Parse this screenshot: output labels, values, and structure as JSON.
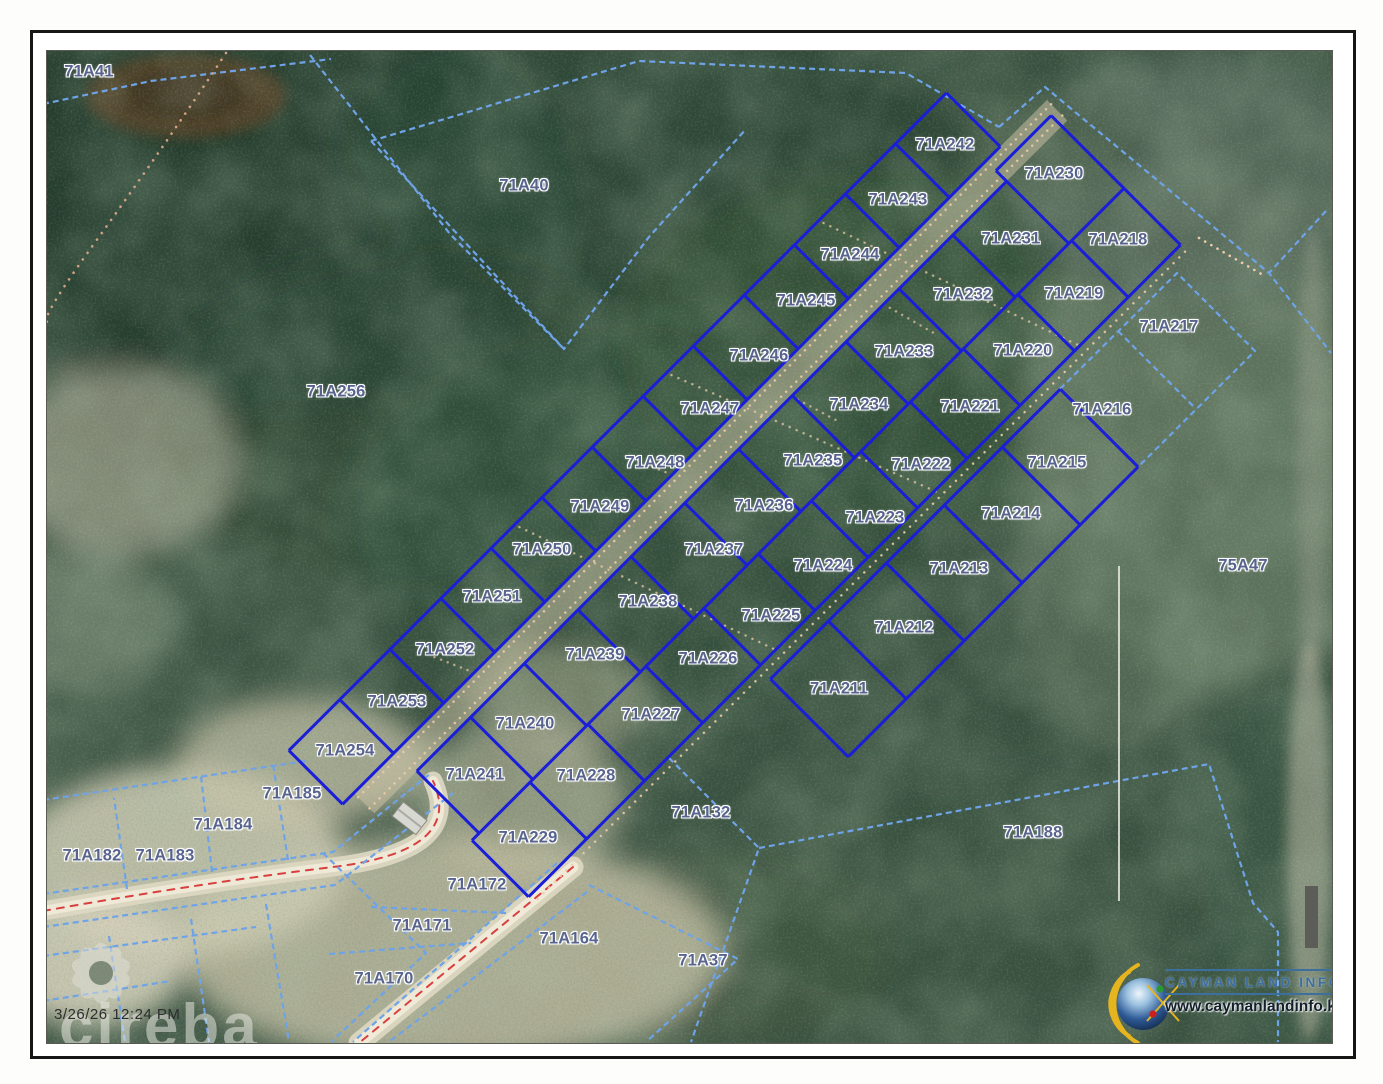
{
  "frame": {
    "border_color": "#161616"
  },
  "map": {
    "timestamp": "3/26/26 12:24 PM",
    "watermark_text": "cireba",
    "labels": [
      {
        "text": "71A41",
        "x": 88,
        "y": 71
      },
      {
        "text": "71A40",
        "x": 523,
        "y": 185
      },
      {
        "text": "71A256",
        "x": 335,
        "y": 391
      },
      {
        "text": "71A242",
        "x": 944,
        "y": 144
      },
      {
        "text": "71A243",
        "x": 897,
        "y": 199
      },
      {
        "text": "71A244",
        "x": 849,
        "y": 254
      },
      {
        "text": "71A245",
        "x": 805,
        "y": 300
      },
      {
        "text": "71A246",
        "x": 758,
        "y": 355
      },
      {
        "text": "71A247",
        "x": 709,
        "y": 408
      },
      {
        "text": "71A248",
        "x": 654,
        "y": 462
      },
      {
        "text": "71A249",
        "x": 599,
        "y": 506
      },
      {
        "text": "71A250",
        "x": 541,
        "y": 549
      },
      {
        "text": "71A251",
        "x": 491,
        "y": 596
      },
      {
        "text": "71A252",
        "x": 444,
        "y": 649
      },
      {
        "text": "71A253",
        "x": 396,
        "y": 701
      },
      {
        "text": "71A254",
        "x": 344,
        "y": 750
      },
      {
        "text": "71A230",
        "x": 1053,
        "y": 173
      },
      {
        "text": "71A231",
        "x": 1010,
        "y": 238
      },
      {
        "text": "71A218",
        "x": 1117,
        "y": 239
      },
      {
        "text": "71A232",
        "x": 962,
        "y": 294
      },
      {
        "text": "71A219",
        "x": 1073,
        "y": 293
      },
      {
        "text": "71A217",
        "x": 1168,
        "y": 326
      },
      {
        "text": "71A233",
        "x": 903,
        "y": 351
      },
      {
        "text": "71A220",
        "x": 1022,
        "y": 350
      },
      {
        "text": "71A234",
        "x": 858,
        "y": 404
      },
      {
        "text": "71A221",
        "x": 969,
        "y": 406
      },
      {
        "text": "71A216",
        "x": 1101,
        "y": 409
      },
      {
        "text": "71A235",
        "x": 812,
        "y": 460
      },
      {
        "text": "71A222",
        "x": 920,
        "y": 464
      },
      {
        "text": "71A215",
        "x": 1056,
        "y": 462
      },
      {
        "text": "71A236",
        "x": 763,
        "y": 505
      },
      {
        "text": "71A223",
        "x": 874,
        "y": 517
      },
      {
        "text": "71A214",
        "x": 1010,
        "y": 513
      },
      {
        "text": "71A237",
        "x": 713,
        "y": 549
      },
      {
        "text": "71A224",
        "x": 822,
        "y": 565
      },
      {
        "text": "71A213",
        "x": 958,
        "y": 568
      },
      {
        "text": "71A238",
        "x": 647,
        "y": 601
      },
      {
        "text": "71A225",
        "x": 770,
        "y": 615
      },
      {
        "text": "71A212",
        "x": 903,
        "y": 627
      },
      {
        "text": "71A239",
        "x": 594,
        "y": 654
      },
      {
        "text": "71A226",
        "x": 707,
        "y": 658
      },
      {
        "text": "71A211",
        "x": 838,
        "y": 688
      },
      {
        "text": "71A227",
        "x": 650,
        "y": 714
      },
      {
        "text": "71A240",
        "x": 524,
        "y": 723
      },
      {
        "text": "71A241",
        "x": 474,
        "y": 774
      },
      {
        "text": "71A228",
        "x": 585,
        "y": 775
      },
      {
        "text": "71A229",
        "x": 527,
        "y": 837
      },
      {
        "text": "71A185",
        "x": 291,
        "y": 793
      },
      {
        "text": "71A184",
        "x": 222,
        "y": 824
      },
      {
        "text": "71A182",
        "x": 91,
        "y": 855
      },
      {
        "text": "71A183",
        "x": 164,
        "y": 855
      },
      {
        "text": "71A132",
        "x": 700,
        "y": 812
      },
      {
        "text": "71A188",
        "x": 1032,
        "y": 832
      },
      {
        "text": "71A172",
        "x": 476,
        "y": 884
      },
      {
        "text": "71A171",
        "x": 421,
        "y": 925
      },
      {
        "text": "71A164",
        "x": 568,
        "y": 938
      },
      {
        "text": "71A170",
        "x": 383,
        "y": 978
      },
      {
        "text": "71A37",
        "x": 702,
        "y": 960
      },
      {
        "text": "75A47",
        "x": 1242,
        "y": 565
      }
    ]
  },
  "logo": {
    "title": "CAYMAN LAND INFO",
    "url": "www.caymanlandinfo.ky"
  },
  "colors": {
    "parcel_highlight": "#1a1ed8",
    "parcel_boundary": "#6fa3e8",
    "label_text": "#58648e",
    "road_centerline": "#d84040",
    "trail_dots": "#eecbaa"
  }
}
